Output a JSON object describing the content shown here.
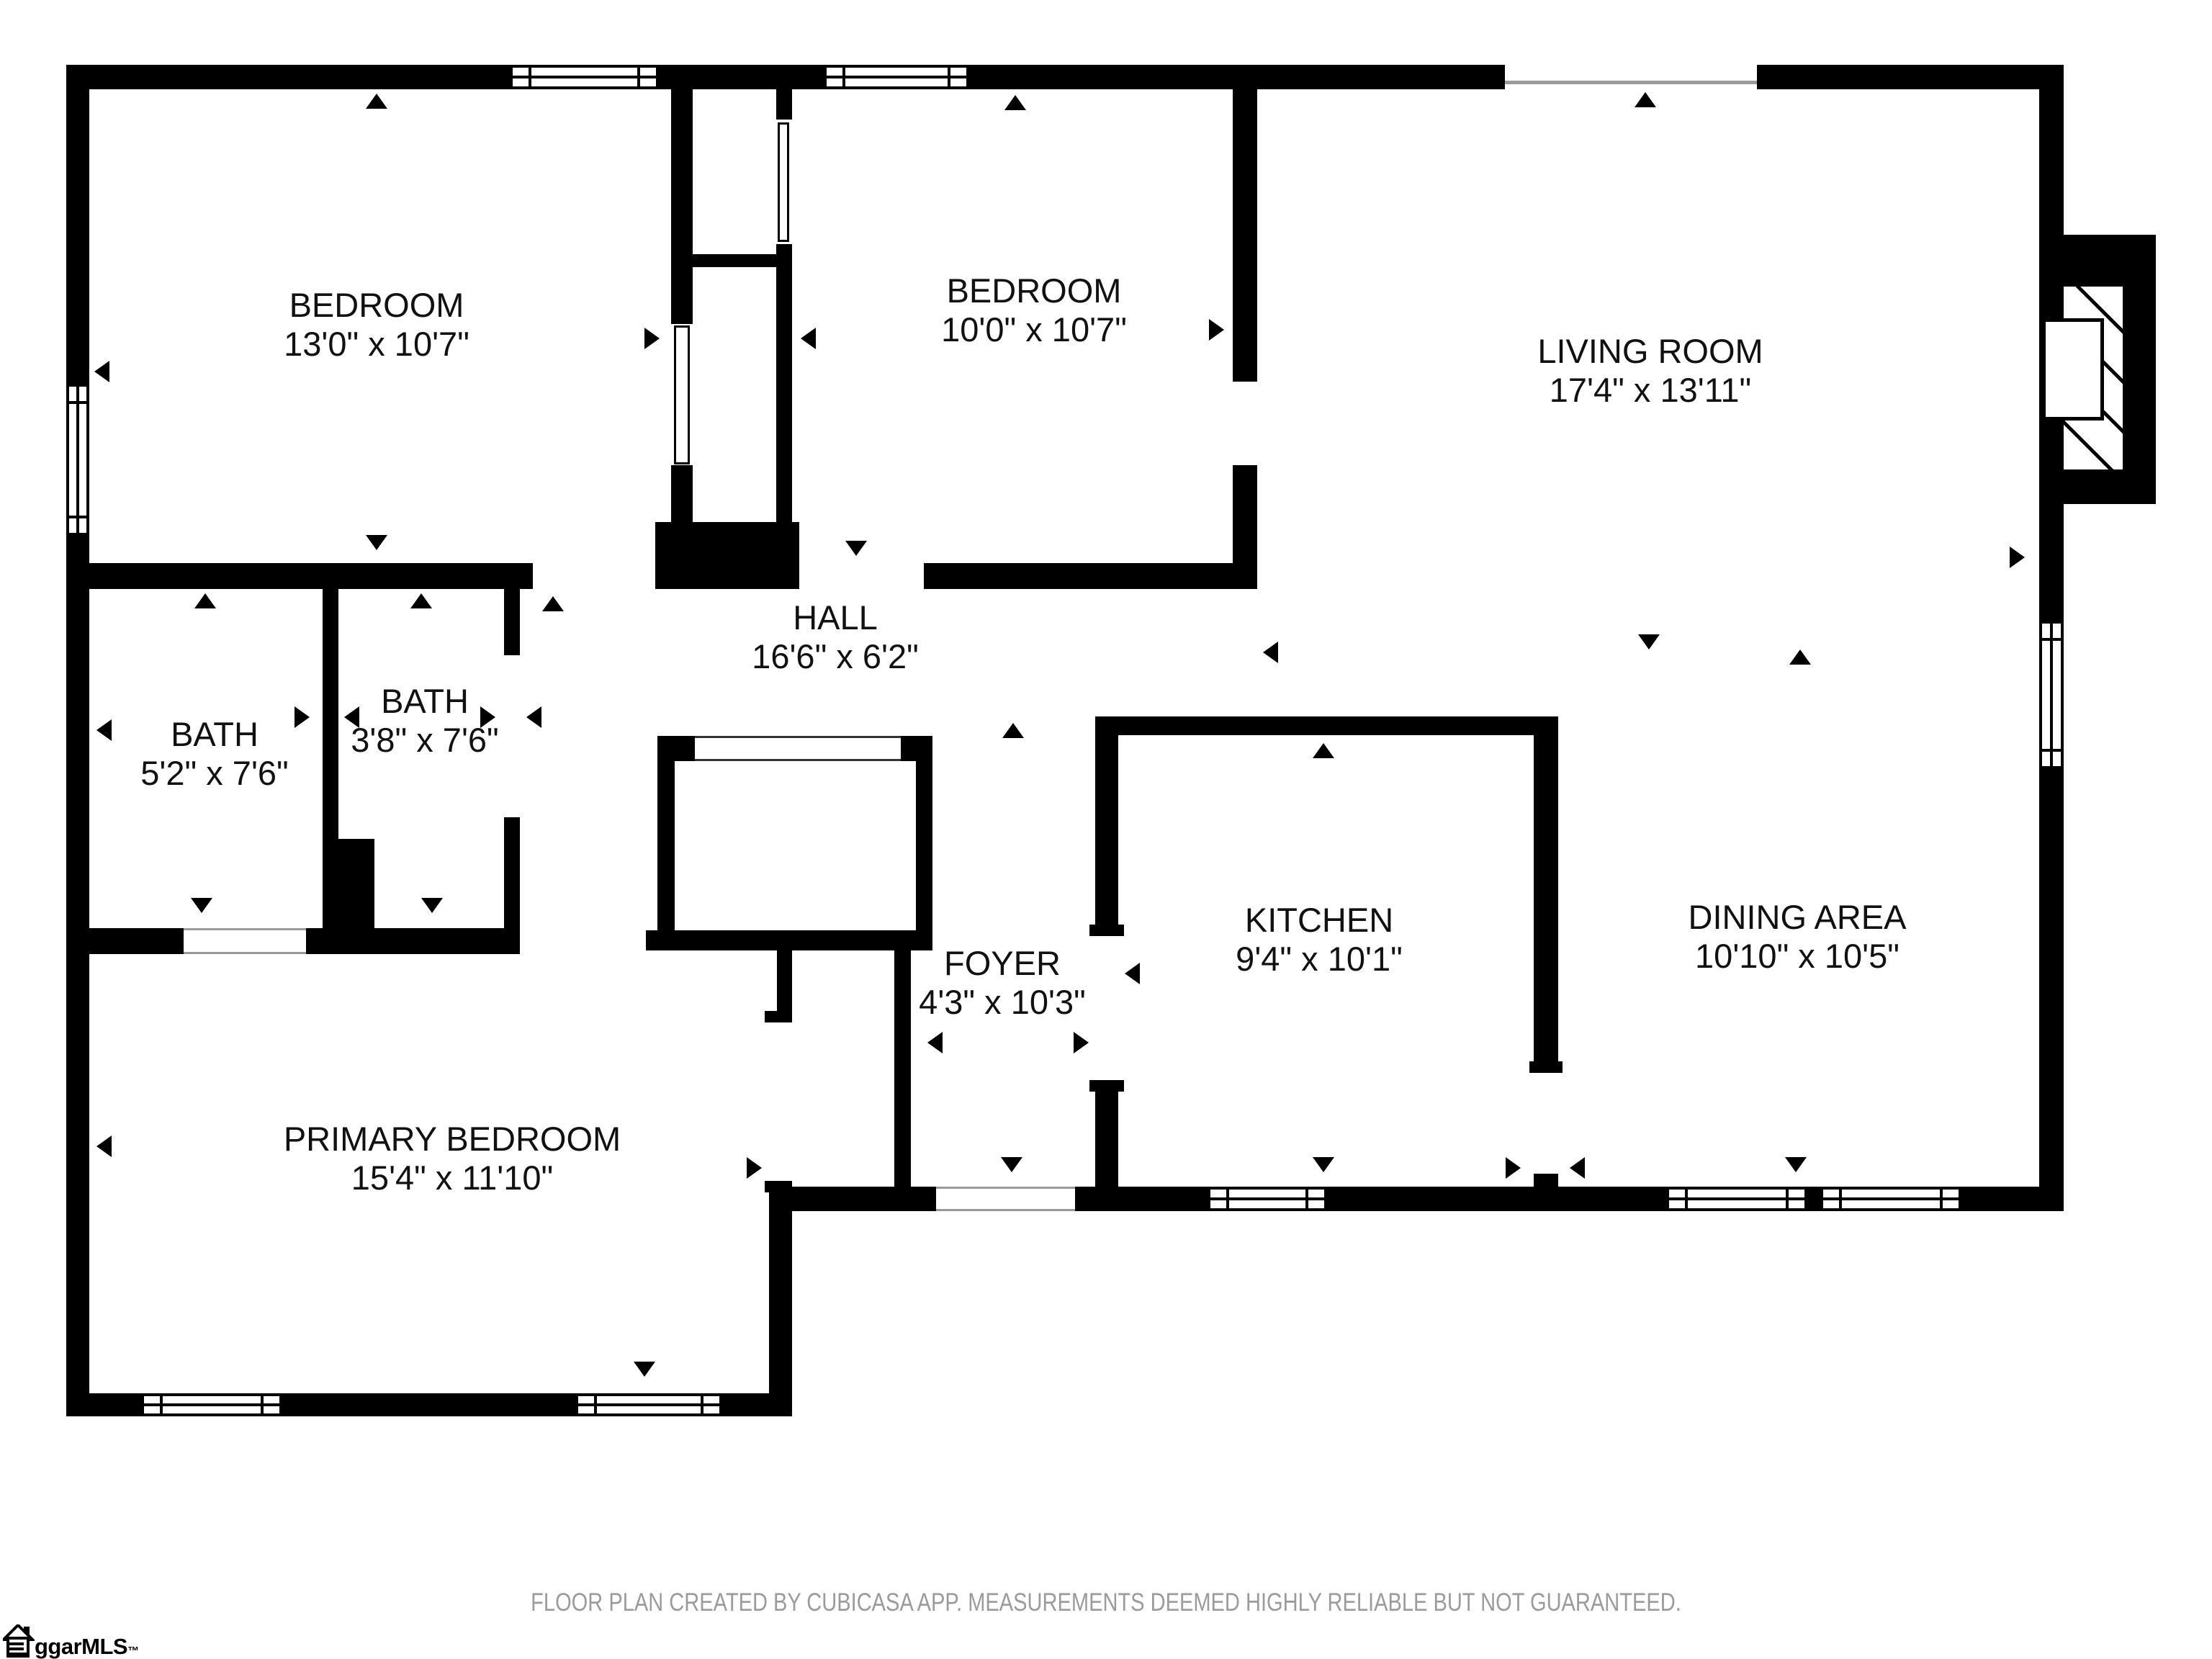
{
  "colors": {
    "wall": "#000000",
    "label": "#111111",
    "disclaimer": "#9b9b9b",
    "background": "#ffffff"
  },
  "rooms": {
    "bedroom1": {
      "name": "BEDROOM",
      "dims": "13'0\" x 10'7\""
    },
    "bedroom2": {
      "name": "BEDROOM",
      "dims": "10'0\" x 10'7\""
    },
    "living": {
      "name": "LIVING ROOM",
      "dims": "17'4\" x 13'11\""
    },
    "hall": {
      "name": "HALL",
      "dims": "16'6\" x 6'2\""
    },
    "bath1": {
      "name": "BATH",
      "dims": "5'2\" x 7'6\""
    },
    "bath2": {
      "name": "BATH",
      "dims": "3'8\" x 7'6\""
    },
    "foyer": {
      "name": "FOYER",
      "dims": "4'3\" x 10'3\""
    },
    "kitchen": {
      "name": "KITCHEN",
      "dims": "9'4\" x 10'1\""
    },
    "dining": {
      "name": "DINING AREA",
      "dims": "10'10\" x 10'5\""
    },
    "primary": {
      "name": "PRIMARY BEDROOM",
      "dims": "15'4\" x 11'10\""
    }
  },
  "footer": {
    "disclaimer": "FLOOR PLAN CREATED BY CUBICASA APP. MEASUREMENTS DEEMED HIGHLY RELIABLE BUT NOT GUARANTEED."
  },
  "logo": {
    "text": "ggarMLS",
    "tm": "™"
  }
}
